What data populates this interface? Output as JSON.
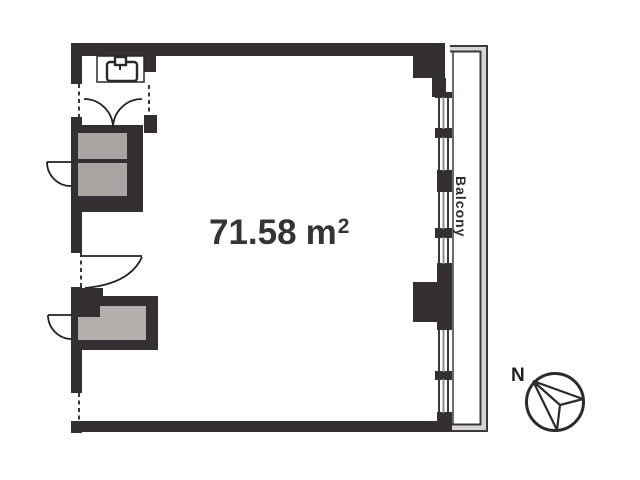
{
  "plan": {
    "area": {
      "value": "71.58",
      "unit": "m",
      "exponent": "2"
    },
    "balcony": {
      "label": "Balcony"
    },
    "compass": {
      "north_label": "N"
    },
    "colors": {
      "wall": "#332f32",
      "closet_fill": "#a8a4a2",
      "counter_fill": "#b3afad",
      "balcony_band": "#d8d5d2",
      "text": "#343434"
    }
  }
}
